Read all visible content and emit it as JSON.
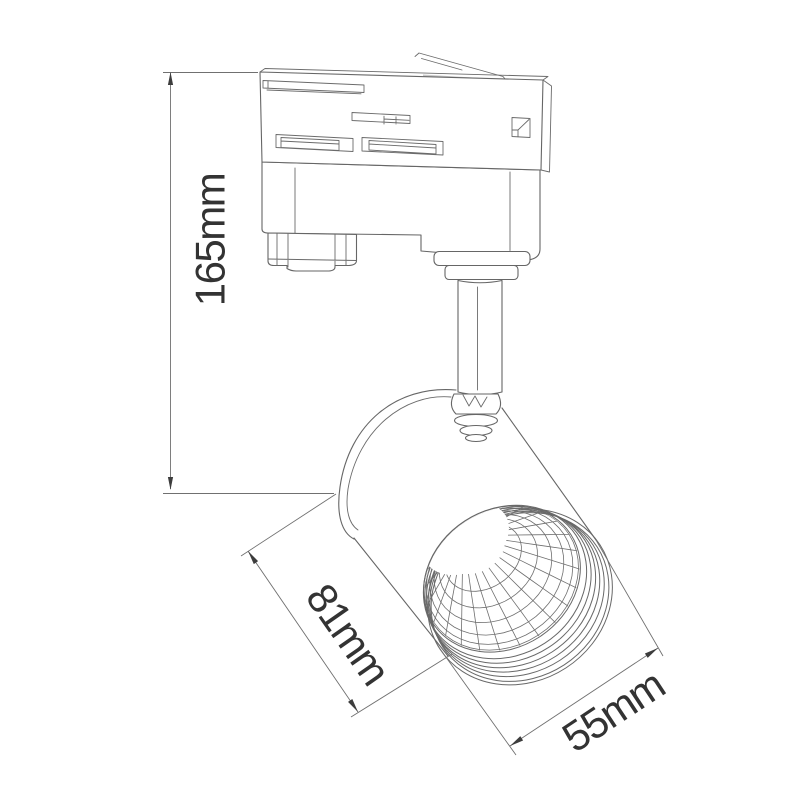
{
  "page": {
    "background": "#ffffff"
  },
  "drawing": {
    "stroke_color": "#666666",
    "dimension_line_color": "#707070",
    "text_color": "#333333",
    "arrow_color": "#3d3d3d",
    "labels": {
      "height": "165mm",
      "body_length": "81mm",
      "head_diameter": "55mm"
    }
  }
}
